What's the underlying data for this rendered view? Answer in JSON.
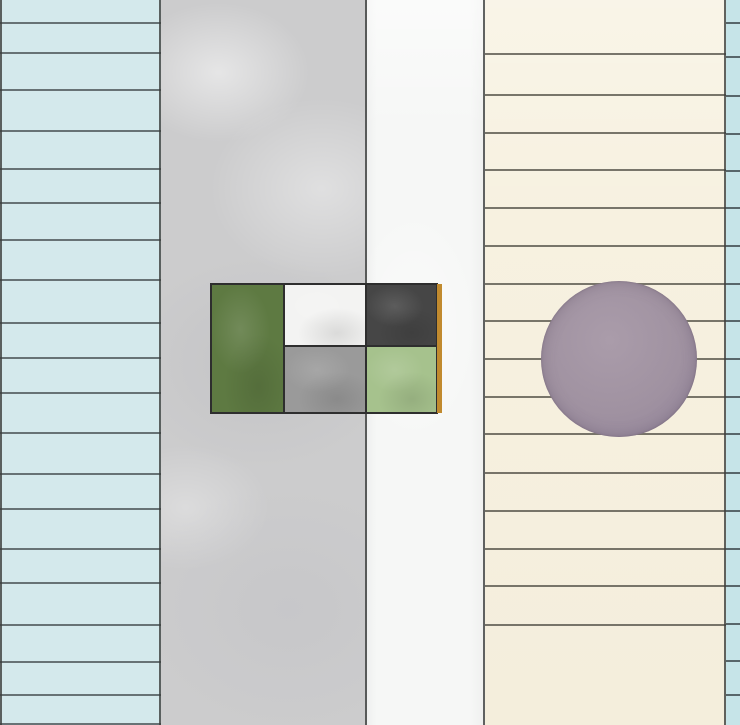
{
  "artwork": {
    "description": "abstract-striped-paper-composition",
    "canvas": {
      "width": 740,
      "height": 725,
      "background": "#eeeeee"
    },
    "boundary_color": "#3b3d3c",
    "boundaries_x": [
      0,
      160,
      366,
      484,
      725
    ],
    "stripes": [
      {
        "name": "stripe-blue-left",
        "x": 0,
        "width": 161,
        "color": "#d4e9ec",
        "texture": "none",
        "ruled": true,
        "line_color": "#4f585a",
        "line_ys": [
          22,
          52,
          89,
          130,
          168,
          202,
          239,
          279,
          322,
          357,
          392,
          432,
          473,
          508,
          548,
          582,
          624,
          661,
          694,
          723
        ]
      },
      {
        "name": "stripe-gray-watercolor",
        "x": 161,
        "width": 206,
        "color": "#cccccd",
        "texture": "watercolor",
        "ruled": false,
        "line_color": "",
        "line_ys": []
      },
      {
        "name": "stripe-white",
        "x": 367,
        "width": 118,
        "color": "#f6f7f6",
        "texture": "paper",
        "ruled": false,
        "line_color": "",
        "line_ys": []
      },
      {
        "name": "stripe-cream-ruled",
        "x": 485,
        "width": 241,
        "color": "#f7f1e0",
        "texture": "flat-soft",
        "ruled": true,
        "line_color": "#5b594f",
        "line_ys": [
          53,
          94,
          132,
          169,
          207,
          245,
          283,
          320,
          358,
          396,
          433,
          472,
          510,
          548,
          585,
          624
        ]
      },
      {
        "name": "stripe-blue-right",
        "x": 726,
        "width": 14,
        "color": "#c6e4e8",
        "texture": "none",
        "ruled": true,
        "line_color": "#3f4b4e",
        "line_ys": [
          22,
          56,
          95,
          133,
          170,
          207,
          245,
          283,
          320,
          358,
          396,
          433,
          472,
          510,
          548,
          585,
          623,
          660,
          694
        ]
      }
    ],
    "block": {
      "name": "color-block",
      "x": 211,
      "y": 284,
      "width": 226,
      "height": 129,
      "border_color": "#2e2e2e",
      "cells": [
        {
          "name": "cell-dark-green",
          "x": 0,
          "y": 0,
          "w": 73,
          "h": 129,
          "color": "#5e7a42"
        },
        {
          "name": "cell-white",
          "x": 73,
          "y": 0,
          "w": 82,
          "h": 62,
          "color": "#f3f3f2"
        },
        {
          "name": "cell-charcoal",
          "x": 155,
          "y": 0,
          "w": 71,
          "h": 62,
          "color": "#464646"
        },
        {
          "name": "cell-gray",
          "x": 73,
          "y": 62,
          "w": 82,
          "h": 67,
          "color": "#9a9a9a"
        },
        {
          "name": "cell-light-green",
          "x": 155,
          "y": 62,
          "w": 71,
          "h": 67,
          "color": "#a6c28d"
        }
      ],
      "accent_strip": {
        "name": "accent-strip-orange",
        "x": 226,
        "y": 0,
        "w": 5,
        "h": 129,
        "color": "#c18a2e"
      }
    },
    "circle": {
      "name": "circle-mauve",
      "cx": 619,
      "cy": 359,
      "r": 78,
      "color": "#a092a1",
      "highlight": "#aa9caa",
      "edge": "#91839a"
    }
  }
}
